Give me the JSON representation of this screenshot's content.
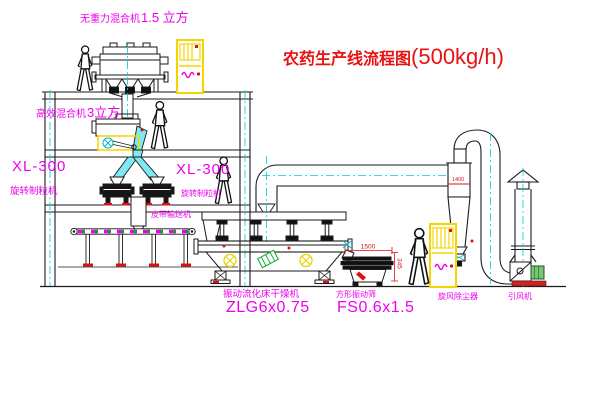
{
  "title": {
    "text": "农药生产线流程图",
    "capacity": "(500kg/h)"
  },
  "labels": {
    "top_mixer_name": "无重力混合机",
    "top_mixer_size": "1.5 立方",
    "mixer2_name": "高效混合机",
    "mixer2_size": "3立方",
    "xl300_left": "XL-300",
    "granulator_left": "旋转制粒机",
    "xl300_right": "XL-300",
    "granulator_right": "旋转制粒机",
    "belt_conveyor": "皮带输送机",
    "dryer_name": "振动流化床干燥机",
    "dryer_model": "ZLG6x0.75",
    "sieve_name": "方形振动筛",
    "sieve_model": "FS0.6x1.5",
    "cyclone": "旋风除尘器",
    "fan": "引风机"
  },
  "dimensions": {
    "sieve_length": "1500",
    "sieve_height": "345",
    "cyclone_dim": "1400"
  },
  "colors": {
    "label_magenta": "#ee00ee",
    "title_red": "#e81212",
    "dimension_red": "#dd1111",
    "line_black": "#1a1a1a",
    "centerline_cyan": "#00cddd",
    "cabinet_yellow": "#f5d400",
    "chute_cyan": "#7ee9f2",
    "belt_green": "#00aa22",
    "motor_green": "#76c776"
  }
}
